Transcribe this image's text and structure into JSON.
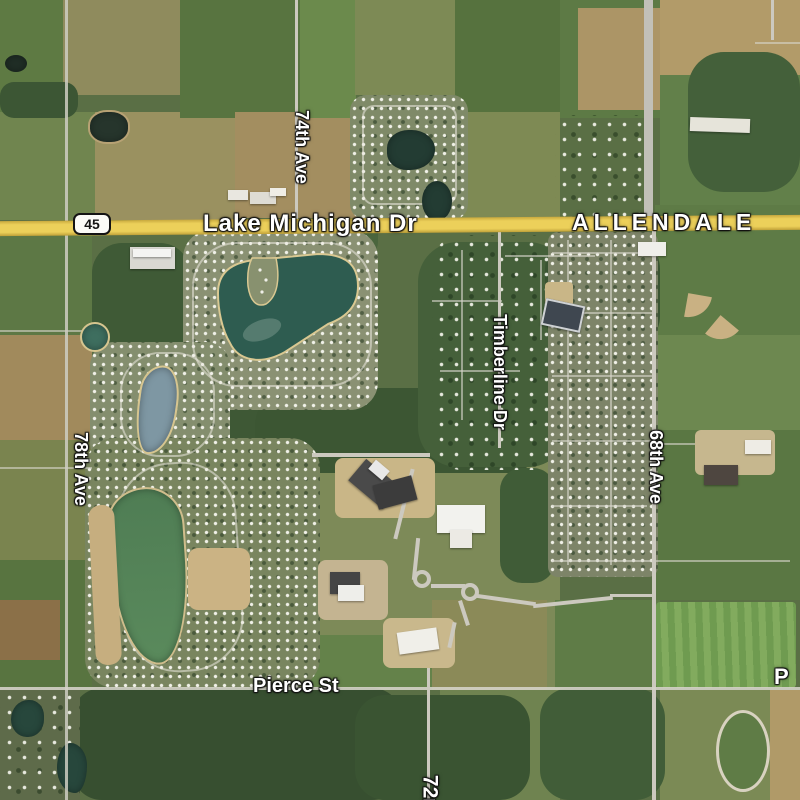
{
  "map": {
    "place_label": "ALLENDALE",
    "route_shield": "45",
    "roads": {
      "lake_michigan_dr": "Lake Michigan Dr",
      "ave_74": "74th Ave",
      "ave_78": "78th Ave",
      "ave_68": "68th Ave",
      "timberline_dr": "Timberline Dr",
      "pierce_st": "Pierce St",
      "ave_72_partial": "72n",
      "pierce_partial": "P"
    },
    "colors": {
      "highway_yellow": "#ecd05a",
      "road_gray": "#ccc9bf",
      "pond_teal": "#2e5c50",
      "pond_green": "#538156",
      "pond_blue_gray": "#7e97a3",
      "forest_dark_green": "#3a5132",
      "field_tan": "#a98f60",
      "label_white": "#ffffff"
    }
  }
}
